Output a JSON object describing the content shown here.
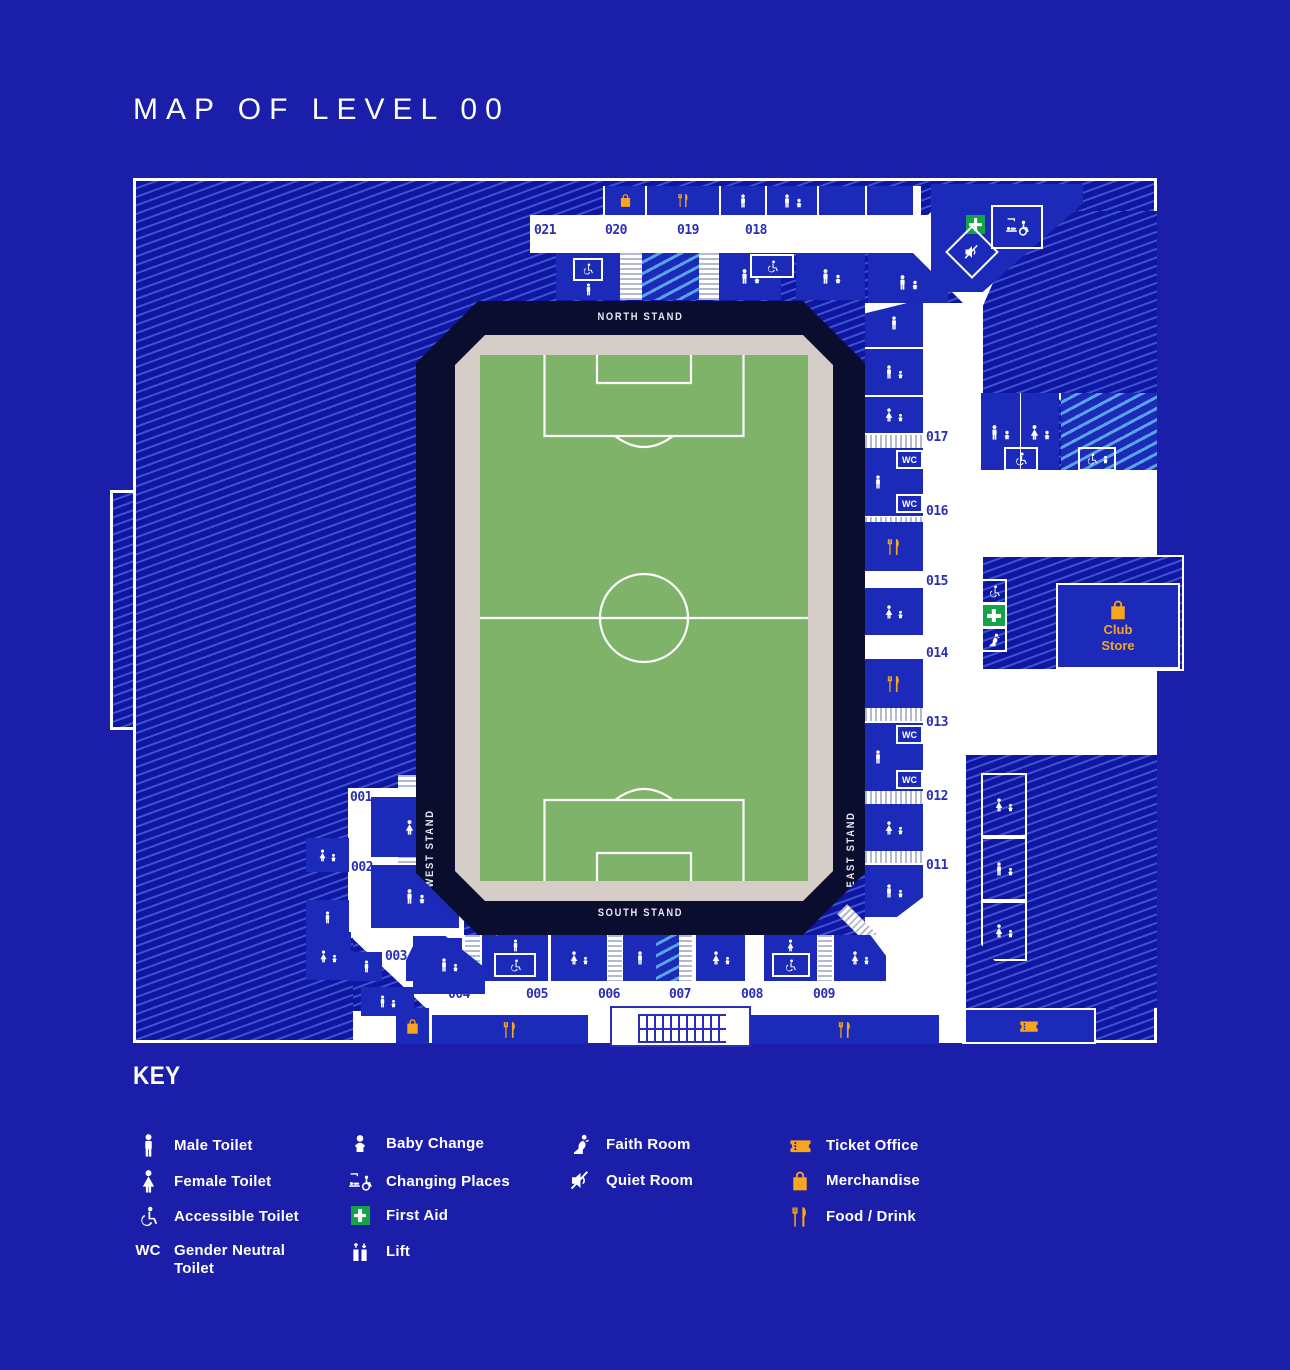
{
  "title": "MAP OF LEVEL 00",
  "map": {
    "stands": {
      "north": "NORTH STAND",
      "south": "SOUTH STAND",
      "west": "WEST STAND",
      "east": "EAST STAND"
    },
    "numbers": {
      "n001": "001",
      "n002": "002",
      "n003": "003",
      "n004": "004",
      "n005": "005",
      "n006": "006",
      "n007": "007",
      "n008": "008",
      "n009": "009",
      "n010": "010",
      "n011": "011",
      "n012": "012",
      "n013": "013",
      "n014": "014",
      "n015": "015",
      "n016": "016",
      "n017": "017",
      "n018": "018",
      "n019": "019",
      "n020": "020",
      "n021": "021"
    },
    "wc_label": "WC",
    "club_store": {
      "line1": "Club",
      "line2": "Store"
    }
  },
  "key": {
    "heading": "KEY",
    "white_items": [
      {
        "icon": "male-toilet-icon",
        "label": "Male Toilet"
      },
      {
        "icon": "female-toilet-icon",
        "label": "Female Toilet"
      },
      {
        "icon": "accessible-toilet-icon",
        "label": "Accessible Toilet"
      },
      {
        "icon": "wc-text-icon",
        "label": "Gender Neutral Toilet",
        "label_line1": "Gender Neutral",
        "label_line2": "Toilet"
      },
      {
        "icon": "baby-change-icon",
        "label": "Baby Change"
      },
      {
        "icon": "changing-places-icon",
        "label": "Changing Places"
      },
      {
        "icon": "first-aid-icon",
        "label": "First Aid"
      },
      {
        "icon": "lift-icon",
        "label": "Lift"
      },
      {
        "icon": "faith-room-icon",
        "label": "Faith Room"
      },
      {
        "icon": "quiet-room-icon",
        "label": "Quiet Room"
      }
    ],
    "orange_items": [
      {
        "icon": "ticket-office-icon",
        "label": "Ticket Office"
      },
      {
        "icon": "merchandise-icon",
        "label": "Merchandise"
      },
      {
        "icon": "food-drink-icon",
        "label": "Food / Drink"
      }
    ]
  },
  "colors": {
    "background": "#1A1EA9",
    "block_blue": "#1B2AB8",
    "bowl_navy": "#0A0D2E",
    "pitch_green": "#7EB369",
    "pitch_surround": "#D5CDC8",
    "accent_orange": "#F6A51C",
    "first_aid_green": "#15A24A",
    "number_blue": "#2A2FB5"
  }
}
